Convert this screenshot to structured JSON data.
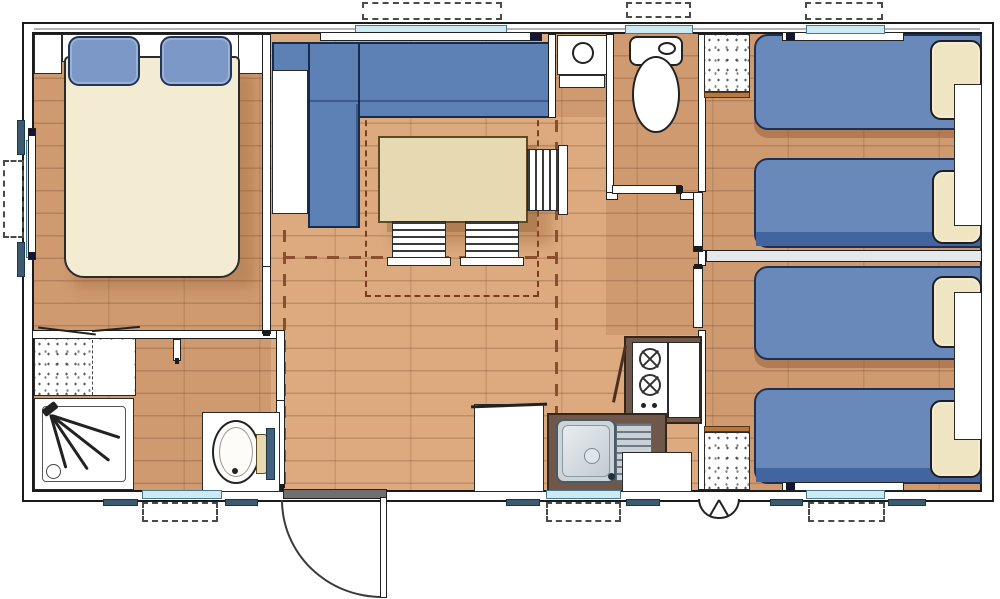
{
  "plan": {
    "title": "Mobile home floor plan",
    "colors": {
      "floor_dark": "#cf9a70",
      "floor_light": "#dcaa7e",
      "bed_blue": "#6889ba",
      "bed_band_blue": "#43659f",
      "sofa_blue": "#5d81b5",
      "pillow_cream": "#f0e5c2",
      "bed_cream": "#f4ecd2",
      "table_beige": "#e7dab3",
      "counter_brown": "#6f584a",
      "window_glass": "#cde9f2",
      "shutter_slate": "#3c5a70",
      "zone_dash_brown": "#8a4f2e",
      "skylight_dash": "#7a3d1d"
    },
    "rooms": [
      {
        "name": "master bedroom",
        "furniture": [
          "double bed",
          "blue pillows",
          "headboard shelf",
          "corner wardrobe left",
          "corner wardrobe right",
          "left wall window"
        ]
      },
      {
        "name": "living dining room",
        "furniture": [
          "corner sofa",
          "side cabinet",
          "dining table",
          "chair",
          "chair",
          "chair",
          "skylight marking",
          "front window"
        ]
      },
      {
        "name": "wc room",
        "furniture": [
          "toilet",
          "door",
          "window"
        ]
      },
      {
        "name": "water heater alcove",
        "furniture": [
          "water heater unit",
          "shelf"
        ]
      },
      {
        "name": "kitchen",
        "furniture": [
          "sink unit",
          "drainer",
          "gas hob",
          "low cabinet",
          "tall cabinet",
          "freezer cabinet",
          "window"
        ]
      },
      {
        "name": "shower room",
        "furniture": [
          "shower cabin",
          "washbasin vanity",
          "mirror",
          "wardrobe",
          "door",
          "window"
        ]
      },
      {
        "name": "bedroom 1",
        "furniture": [
          "twin bed",
          "twin bed",
          "nightstand",
          "wardrobe",
          "door",
          "window"
        ]
      },
      {
        "name": "bedroom 2",
        "furniture": [
          "twin bed",
          "twin bed",
          "nightstand",
          "wardrobe",
          "door",
          "window"
        ]
      }
    ],
    "exterior": {
      "entrance_door": "open entrance door with swing arc, bottom wall",
      "wheel": "axle wheel marker under chassis",
      "window_projections": "dashed rectangles outside each window",
      "shutter_marks": "slate bars beside each opening"
    }
  }
}
